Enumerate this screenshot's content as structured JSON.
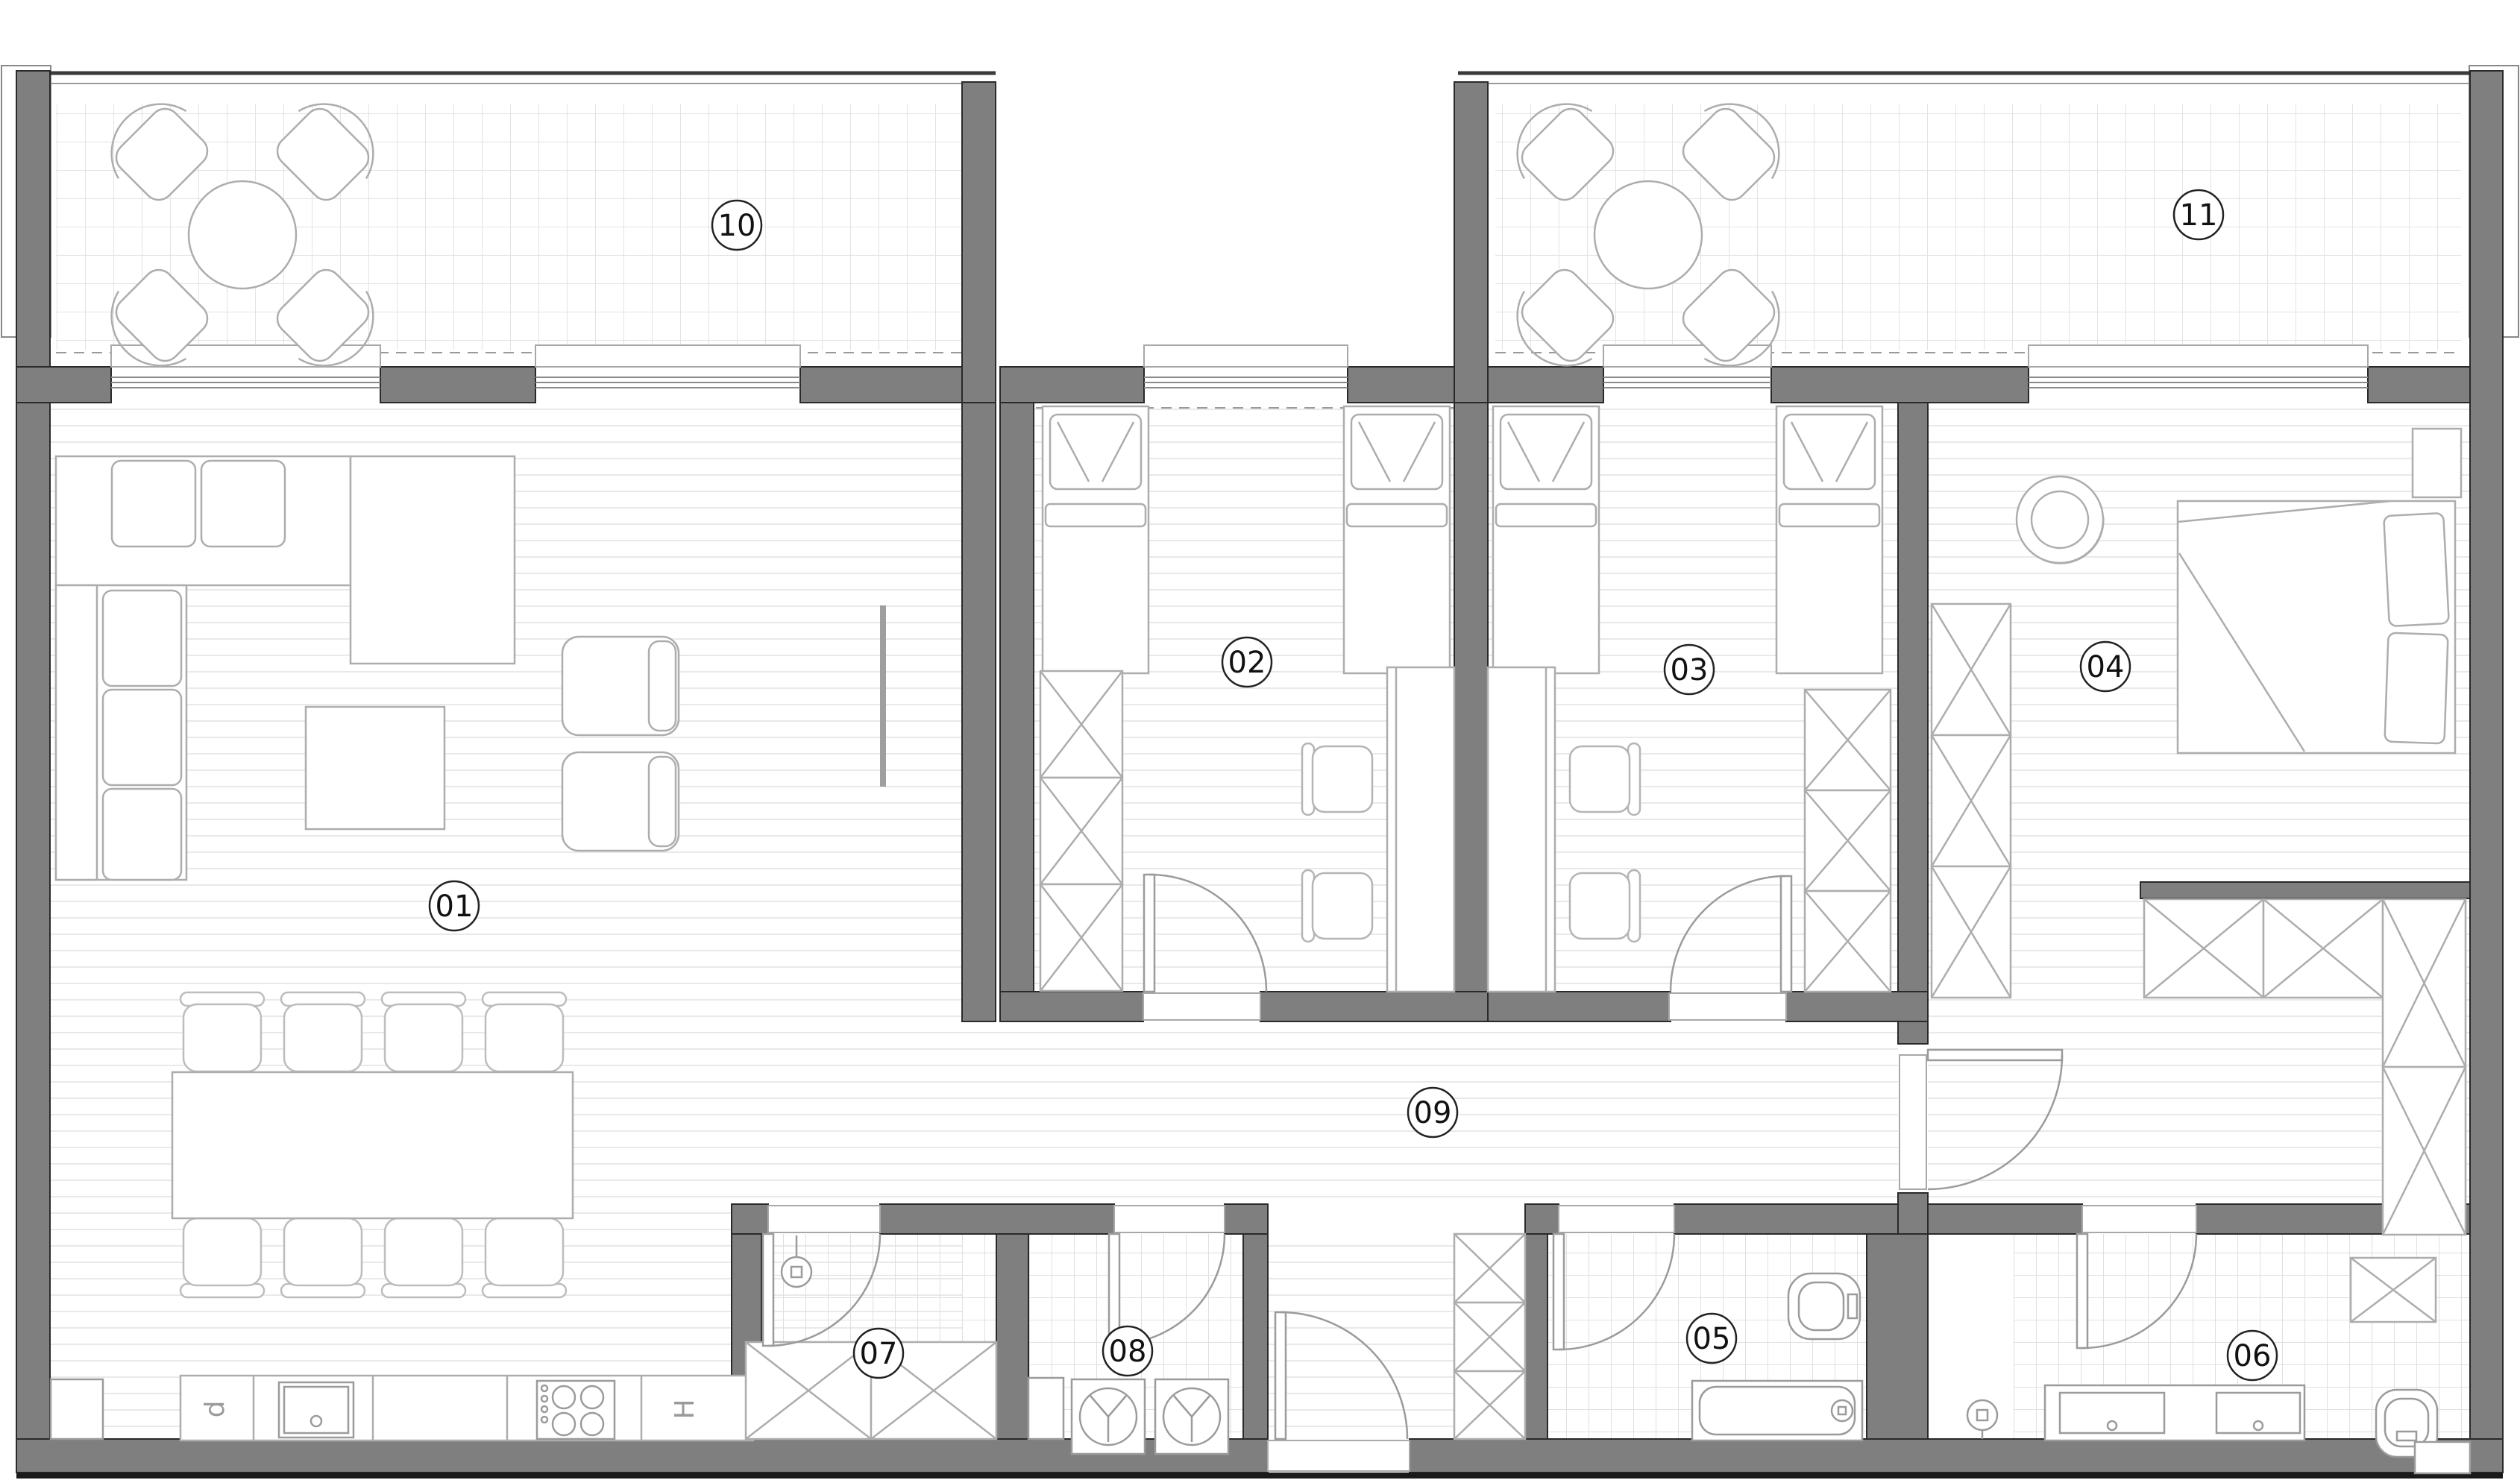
{
  "rooms": [
    {
      "number": "01"
    },
    {
      "number": "02"
    },
    {
      "number": "03"
    },
    {
      "number": "04"
    },
    {
      "number": "05"
    },
    {
      "number": "06"
    },
    {
      "number": "07"
    },
    {
      "number": "08"
    },
    {
      "number": "09"
    },
    {
      "number": "10"
    },
    {
      "number": "11"
    }
  ],
  "kitchen": {
    "dishwasher": "d",
    "hood": "H"
  },
  "colors": {
    "wall": "#7f7f7f",
    "wall_edge": "#2a2a2a",
    "furniture_line": "#adadad",
    "floor_line": "#e9e9e9",
    "tile_line": "#e3e3e3",
    "label_stroke": "#222222",
    "background": "#ffffff"
  }
}
